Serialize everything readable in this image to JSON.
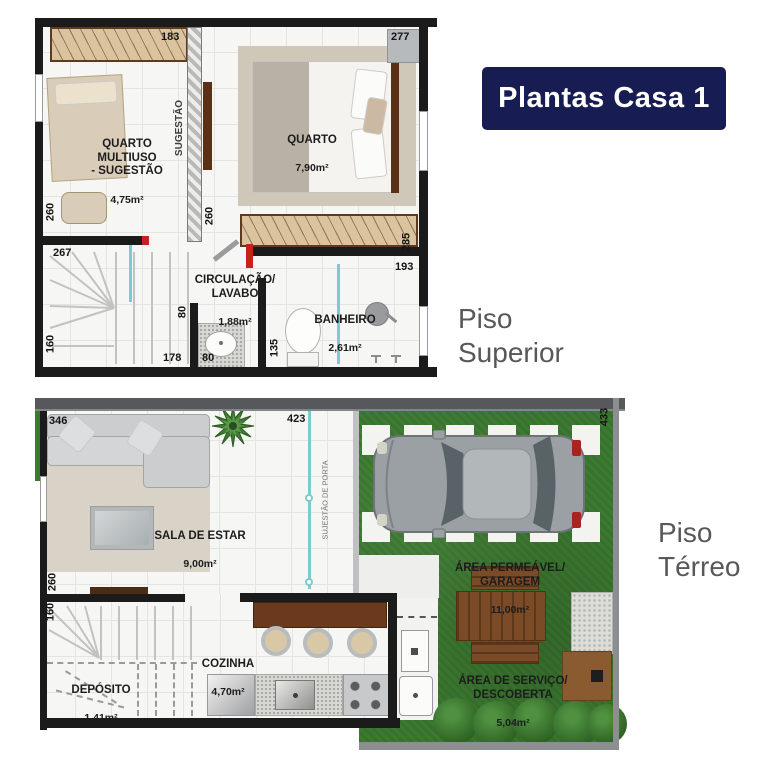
{
  "badge": {
    "label": "Plantas Casa 1"
  },
  "captions": {
    "superior": "Piso Superior",
    "terreo": "Piso Térreo"
  },
  "colors": {
    "badge_bg": "#171c52",
    "badge_text": "#ffffff",
    "caption_text": "#57585a",
    "teal": "#7ccbd0",
    "grass": "#3c7a31",
    "wall": "#1b1b1b"
  },
  "superior": {
    "rooms": {
      "multiuso": {
        "name": "QUARTO\nMULTIUSO\n- SUGESTÃO",
        "area": "4,75m²"
      },
      "quarto": {
        "name": "QUARTO",
        "area": "7,90m²"
      },
      "circulacao": {
        "name": "CIRCULAÇÃO/\nLAVABO",
        "area": "1,88m²"
      },
      "banheiro": {
        "name": "BANHEIRO",
        "area": "2,61m²"
      }
    },
    "notes": {
      "sugestao": "SUGESTÃO"
    },
    "dims": {
      "closet_top": "183",
      "quarto_top": "277",
      "left_upper": "260",
      "mid_260": "260",
      "left_267": "267",
      "closet_right": "285",
      "banheiro_top": "193",
      "lavabo_v80": "80",
      "stairs_178": "178",
      "lavabo_h80": "80",
      "banheiro_135": "135",
      "left_160": "160"
    }
  },
  "terreo": {
    "rooms": {
      "sala": {
        "name": "SALA DE ESTAR",
        "area": "9,00m²"
      },
      "cozinha": {
        "name": "COZINHA",
        "area": "4,70m²"
      },
      "deposito": {
        "name": "DEPÓSITO",
        "area": "1,41m²"
      },
      "garagem": {
        "name": "ÁREA PERMEÁVEL/\nGARAGEM",
        "area": "11,00m²"
      },
      "servico": {
        "name": "ÁREA DE SERVIÇO/\nDESCOBERTA",
        "area": "5,04m²"
      }
    },
    "notes": {
      "porta": "SUJESTÃO DE PORTA"
    },
    "dims": {
      "sala_top": "346",
      "top_mid": "423",
      "right_v": "433",
      "left_260": "260",
      "left_160": "160"
    }
  }
}
